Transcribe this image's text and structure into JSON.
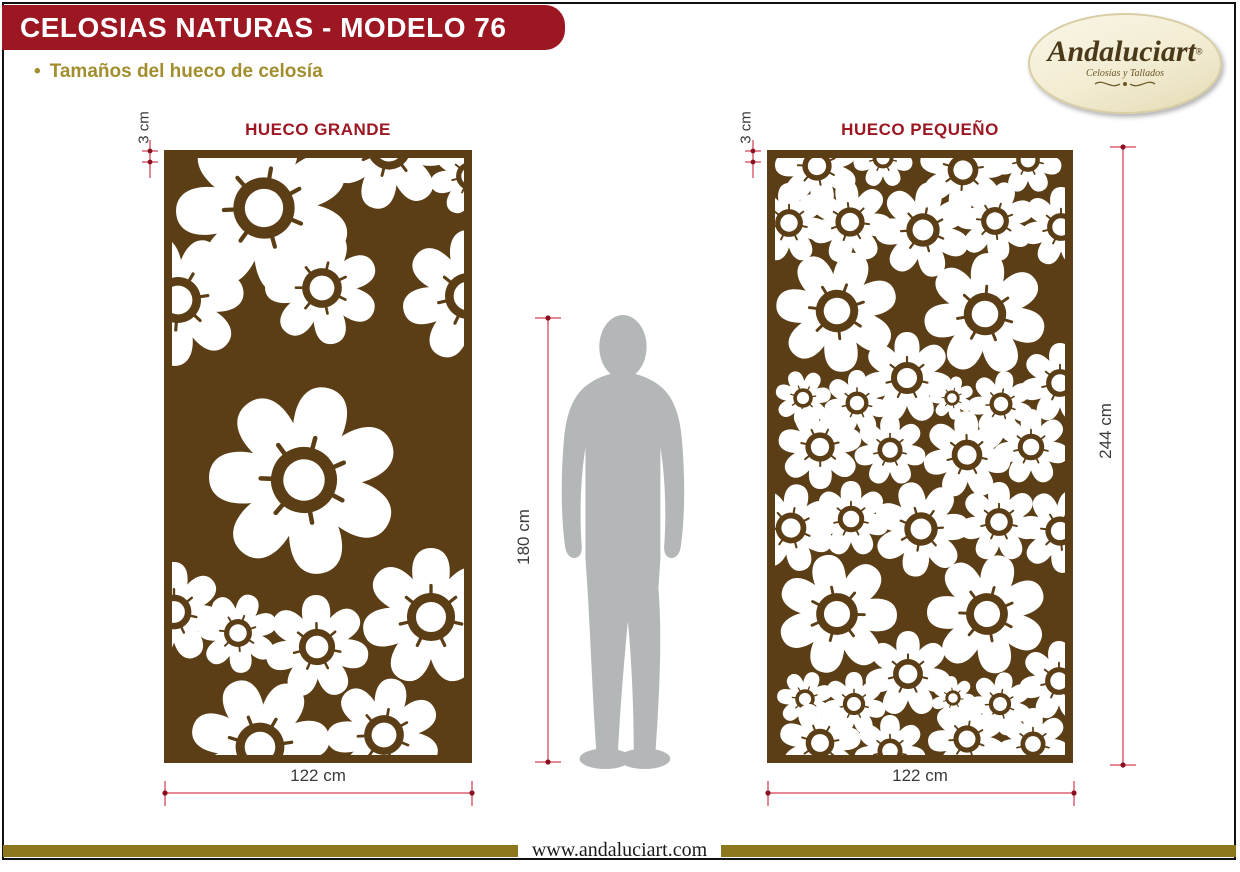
{
  "header": {
    "title": "CELOSIAS NATURAS - MODELO 76",
    "bullet": "•",
    "subtitle": "Tamaños del hueco de celosía"
  },
  "logo": {
    "brand": "Andaluciart",
    "registered": "®",
    "tagline": "Celosías y Tallados"
  },
  "panels": [
    {
      "id": "hueco-grande",
      "title": "HUECO GRANDE",
      "edge_dim": "3 cm",
      "width_dim": "122 cm",
      "pattern": {
        "motif": "white-flower-cutout",
        "flowers": [
          [
            100,
            58,
            88,
            10
          ],
          [
            225,
            -2,
            62,
            40
          ],
          [
            306,
            26,
            40,
            0
          ],
          [
            158,
            138,
            57,
            65
          ],
          [
            14,
            150,
            66,
            30
          ],
          [
            304,
            146,
            66,
            0
          ],
          [
            140,
            330,
            95,
            15
          ],
          [
            10,
            462,
            50,
            0
          ],
          [
            74,
            483,
            40,
            20
          ],
          [
            153,
            497,
            52,
            50
          ],
          [
            267,
            467,
            69,
            0
          ],
          [
            96,
            597,
            70,
            30
          ],
          [
            220,
            585,
            57,
            10
          ]
        ]
      }
    },
    {
      "id": "hueco-pequeno",
      "title": "HUECO PEQUEÑO",
      "edge_dim": "3 cm",
      "width_dim": "122 cm",
      "height_dim": "244 cm",
      "pattern": {
        "motif": "white-flower-cutout",
        "flowers": [
          [
            50,
            16,
            42,
            15
          ],
          [
            116,
            8,
            30,
            0
          ],
          [
            196,
            20,
            44,
            30
          ],
          [
            261,
            10,
            34,
            0
          ],
          [
            22,
            73,
            40,
            0
          ],
          [
            83,
            72,
            42,
            45
          ],
          [
            156,
            80,
            48,
            10
          ],
          [
            228,
            71,
            40,
            70
          ],
          [
            294,
            77,
            40,
            0
          ],
          [
            70,
            161,
            61,
            20
          ],
          [
            218,
            164,
            61,
            55
          ],
          [
            140,
            228,
            46,
            0
          ],
          [
            36,
            248,
            28,
            30
          ],
          [
            90,
            253,
            33,
            0
          ],
          [
            185,
            248,
            22,
            15
          ],
          [
            234,
            254,
            33,
            60
          ],
          [
            293,
            233,
            40,
            0
          ],
          [
            53,
            297,
            42,
            25
          ],
          [
            123,
            300,
            36,
            0
          ],
          [
            200,
            305,
            44,
            50
          ],
          [
            264,
            297,
            38,
            0
          ],
          [
            24,
            378,
            44,
            10
          ],
          [
            84,
            369,
            38,
            0
          ],
          [
            154,
            379,
            48,
            35
          ],
          [
            232,
            372,
            40,
            0
          ],
          [
            293,
            381,
            42,
            20
          ],
          [
            70,
            464,
            60,
            40
          ],
          [
            220,
            464,
            60,
            15
          ],
          [
            141,
            524,
            43,
            0
          ],
          [
            38,
            549,
            28,
            20
          ],
          [
            87,
            554,
            32,
            0
          ],
          [
            186,
            548,
            22,
            45
          ],
          [
            233,
            554,
            32,
            10
          ],
          [
            292,
            531,
            40,
            0
          ],
          [
            53,
            593,
            41,
            30
          ],
          [
            123,
            601,
            36,
            0
          ],
          [
            200,
            589,
            39,
            60
          ],
          [
            266,
            594,
            36,
            0
          ]
        ]
      }
    }
  ],
  "scale_figure": {
    "height_dim": "180 cm"
  },
  "footer": {
    "website": "www.andaluciart.com"
  },
  "colors": {
    "header_red": "#9C1722",
    "panel_brown": "#5B3E16",
    "accent_gold": "#A28E2E",
    "footer_gold": "#8D771D",
    "dimension_red": "#C8102E",
    "dimension_dot_red": "#8B0F1E",
    "silhouette_gray": "#B4B7B8",
    "logo_cream": "#F2ECD2"
  }
}
